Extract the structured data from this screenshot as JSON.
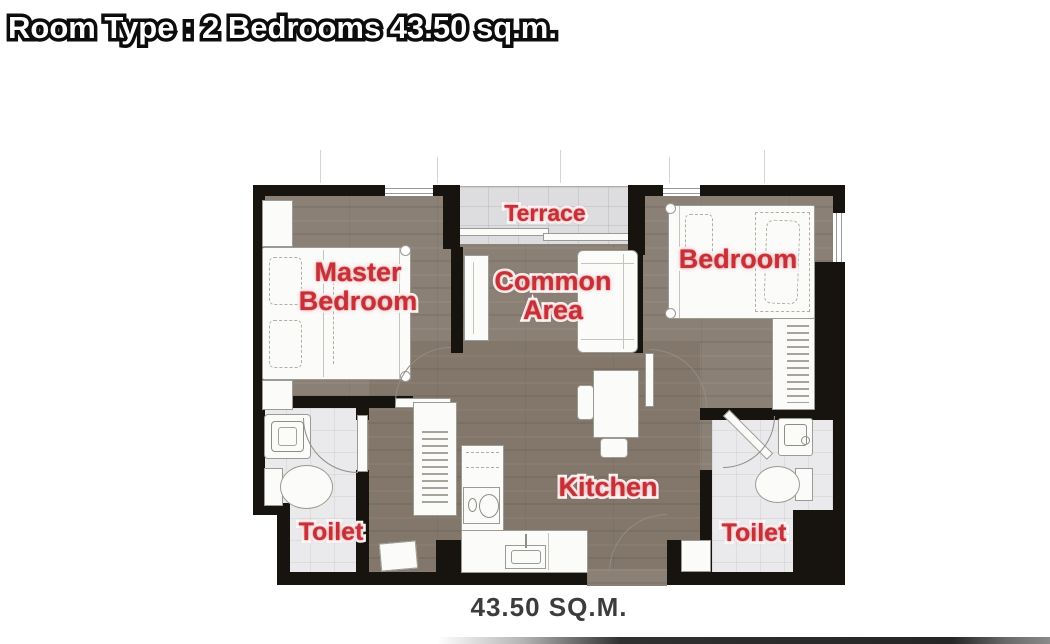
{
  "header": {
    "title": "Room Type : 2 Bedrooms 43.50 sq.m."
  },
  "rooms": {
    "terrace": "Terrace",
    "master_bedroom": "Master Bedroom",
    "common_area": "Common Area",
    "bedroom": "Bedroom",
    "toilet_left": "Toilet",
    "kitchen": "Kitchen",
    "toilet_right": "Toilet"
  },
  "footer": {
    "area_caption": "43.50 SQ.M."
  },
  "colors": {
    "label_red": "#c63037",
    "wall_black": "#17140f",
    "wood_floor": "#8b8075",
    "bath_tile": "#eaeaec",
    "terrace_tile": "#dddde0",
    "title_fill": "#ffffff",
    "title_stroke": "#0e0e0e",
    "caption_gray": "#3c3c3c"
  }
}
